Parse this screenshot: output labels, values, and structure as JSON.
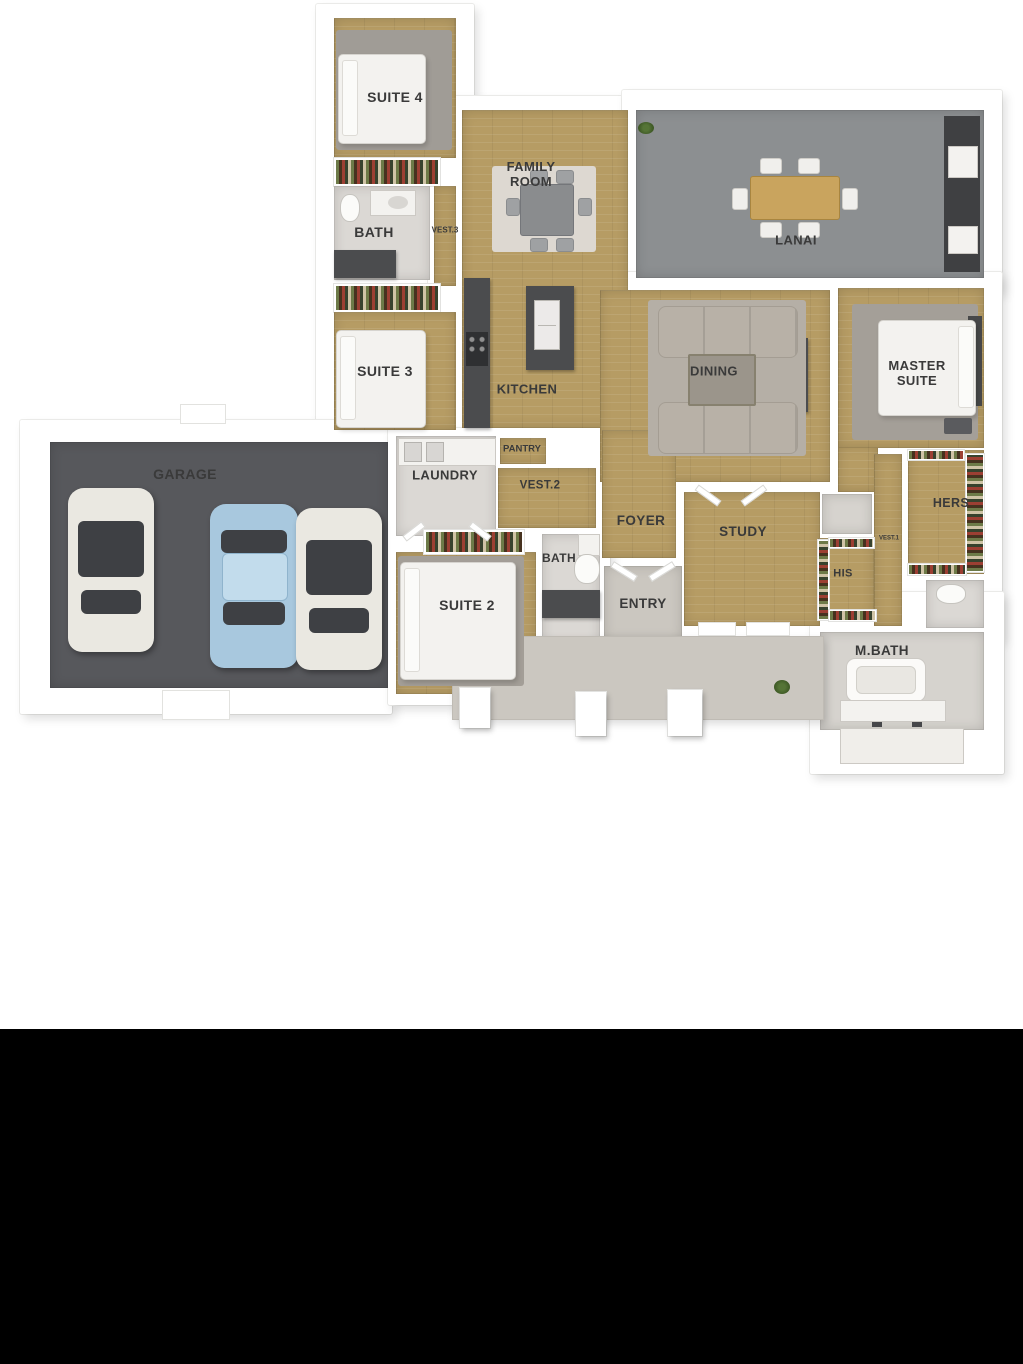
{
  "colors": {
    "wood_floor": "#b69c64",
    "lanai_floor": "#8c8f91",
    "garage_floor": "#57585c",
    "porch_floor": "#cbc7c0",
    "wall_white": "#ffffff",
    "dark_counter": "#4b4c4e",
    "label_text": "#3a3a3a",
    "car_blue": "#a8c8de",
    "car_white": "#eae8e1",
    "letterbox": "#000000"
  },
  "rooms": {
    "suite4": {
      "label": "SUITE 4"
    },
    "bath1": {
      "label": "BATH"
    },
    "vest3": {
      "label": "VEST.3"
    },
    "family_room": {
      "label": "FAMILY ROOM"
    },
    "lanai": {
      "label": "LANAI"
    },
    "suite3": {
      "label": "SUITE 3"
    },
    "kitchen": {
      "label": "KITCHEN"
    },
    "dining": {
      "label": "DINING"
    },
    "master_suite": {
      "label": "MASTER SUITE"
    },
    "garage": {
      "label": "GARAGE"
    },
    "laundry": {
      "label": "LAUNDRY"
    },
    "pantry": {
      "label": "PANTRY"
    },
    "vest2": {
      "label": "VEST.2"
    },
    "foyer": {
      "label": "FOYER"
    },
    "study": {
      "label": "STUDY"
    },
    "his_closet": {
      "label": "HIS"
    },
    "vest1": {
      "label": "VEST.1"
    },
    "hers_closet": {
      "label": "HERS"
    },
    "suite2": {
      "label": "SUITE 2"
    },
    "bath2": {
      "label": "BATH"
    },
    "entry": {
      "label": "ENTRY"
    },
    "master_bath": {
      "label": "M.BATH"
    }
  }
}
